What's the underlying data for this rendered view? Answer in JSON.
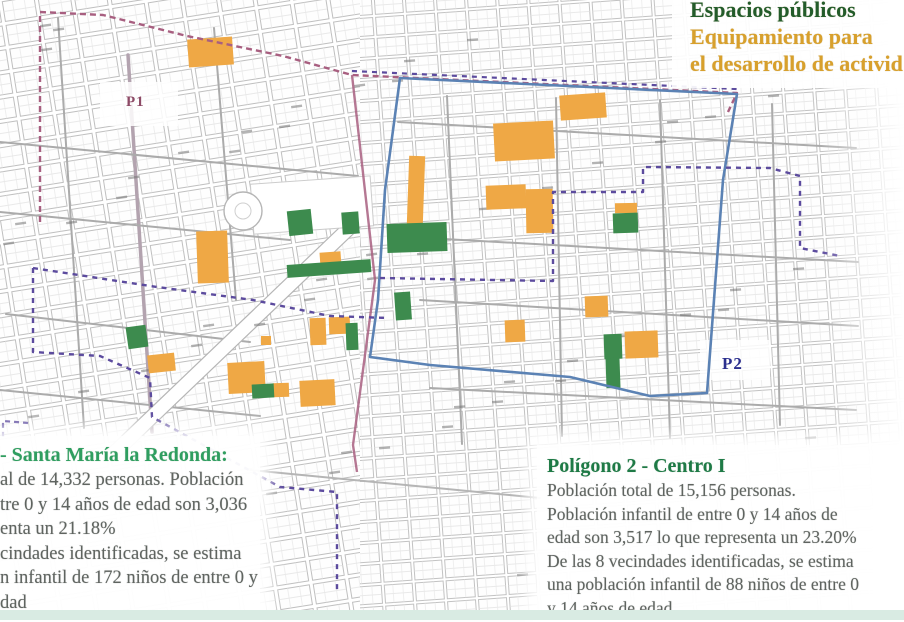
{
  "title": {
    "line1": "Espacios públicos",
    "line2": "Equipamiento para",
    "line3": "el desarrollo de activid",
    "line1_color": "#235c2a",
    "line23_color": "#d8a02c"
  },
  "map": {
    "labels": {
      "p1": {
        "text": "P1",
        "color": "#8d4a66"
      },
      "p2": {
        "text": "P2",
        "color": "#2b2f8e"
      }
    },
    "colors": {
      "equipamiento": "#efa845",
      "espacios": "#3d8b4e",
      "p1_boundary": "#a85f80",
      "p2_boundary": "#5b82b4",
      "outer_dashed": "#5c4b9e",
      "major_street": "#ababab",
      "street_grid": "#c0c0c0"
    },
    "equipamiento_blocks": [
      {
        "x": 188,
        "y": 38,
        "w": 45,
        "h": 28,
        "r": -4
      },
      {
        "x": 560,
        "y": 94,
        "w": 46,
        "h": 25,
        "r": -4
      },
      {
        "x": 494,
        "y": 122,
        "w": 60,
        "h": 38,
        "r": -3
      },
      {
        "x": 408,
        "y": 156,
        "w": 16,
        "h": 68,
        "r": 2
      },
      {
        "x": 486,
        "y": 185,
        "w": 40,
        "h": 24,
        "r": -2
      },
      {
        "x": 526,
        "y": 189,
        "w": 27,
        "h": 44,
        "r": -1
      },
      {
        "x": 197,
        "y": 231,
        "w": 31,
        "h": 52,
        "r": -2
      },
      {
        "x": 320,
        "y": 252,
        "w": 21,
        "h": 15,
        "r": -4
      },
      {
        "x": 148,
        "y": 354,
        "w": 27,
        "h": 18,
        "r": -6
      },
      {
        "x": 228,
        "y": 362,
        "w": 37,
        "h": 31,
        "r": -3
      },
      {
        "x": 300,
        "y": 380,
        "w": 35,
        "h": 26,
        "r": -3
      },
      {
        "x": 310,
        "y": 318,
        "w": 16,
        "h": 27,
        "r": -2
      },
      {
        "x": 329,
        "y": 317,
        "w": 21,
        "h": 17,
        "r": -2
      },
      {
        "x": 261,
        "y": 336,
        "w": 10,
        "h": 9,
        "r": 0
      },
      {
        "x": 615,
        "y": 203,
        "w": 22,
        "h": 10,
        "r": -1
      },
      {
        "x": 585,
        "y": 296,
        "w": 23,
        "h": 21,
        "r": -2
      },
      {
        "x": 625,
        "y": 331,
        "w": 33,
        "h": 27,
        "r": -2
      },
      {
        "x": 505,
        "y": 320,
        "w": 20,
        "h": 22,
        "r": -2
      },
      {
        "x": 273,
        "y": 383,
        "w": 16,
        "h": 14,
        "r": -2
      }
    ],
    "espacios_blocks": [
      {
        "x": 387,
        "y": 223,
        "w": 60,
        "h": 29,
        "r": -2
      },
      {
        "x": 127,
        "y": 326,
        "w": 20,
        "h": 22,
        "r": -8
      },
      {
        "x": 252,
        "y": 384,
        "w": 22,
        "h": 14,
        "r": -3
      },
      {
        "x": 346,
        "y": 323,
        "w": 12,
        "h": 27,
        "r": -2
      },
      {
        "x": 395,
        "y": 292,
        "w": 16,
        "h": 28,
        "r": -4
      },
      {
        "x": 613,
        "y": 213,
        "w": 25,
        "h": 20,
        "r": -2
      },
      {
        "x": 604,
        "y": 334,
        "w": 18,
        "h": 25,
        "r": -2
      },
      {
        "x": 606,
        "y": 358,
        "w": 14,
        "h": 30,
        "r": -2
      },
      {
        "x": 288,
        "y": 210,
        "w": 24,
        "h": 25,
        "r": -6
      },
      {
        "x": 342,
        "y": 212,
        "w": 17,
        "h": 22,
        "r": -4
      },
      {
        "x": 287,
        "y": 262,
        "w": 84,
        "h": 13,
        "r": -4
      }
    ]
  },
  "panel_left": {
    "heading": "- Santa María la Redonda:",
    "heading_color": "#2f9e60",
    "lines": [
      "al de 14,332 personas. Población",
      "tre 0 y 14 años de edad son 3,036",
      "enta un 21.18%",
      "cindades identificadas, se estima",
      "n infantil de 172 niños de entre 0 y",
      "dad"
    ]
  },
  "panel_right": {
    "heading": "Polígono 2 - Centro I",
    "heading_color": "#1e7a46",
    "lines": [
      "Población total de 15,156 personas.",
      "Población infantil de entre 0 y 14 años de",
      "edad son 3,517 lo que representa un 23.20%",
      "De las 8 vecindades identificadas, se estima",
      "una población infantil de 88 niños de entre 0",
      "y 14 años de edad"
    ]
  },
  "footer_bar_color": "#d9ebe3"
}
